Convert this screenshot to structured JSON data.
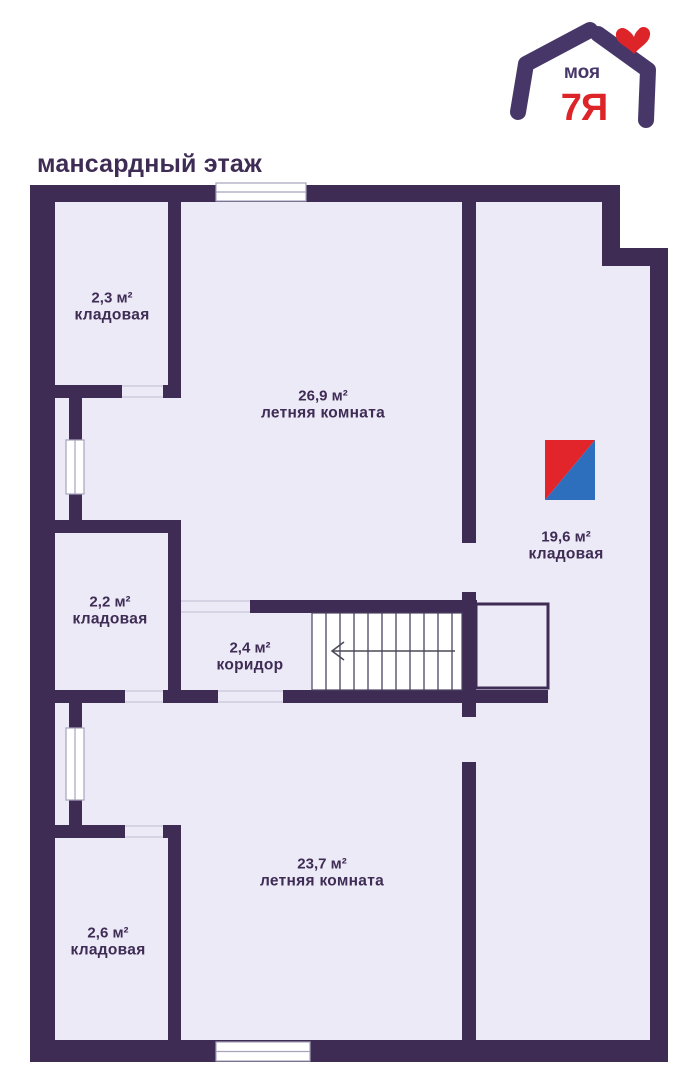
{
  "title": "мансардный этаж",
  "logo": {
    "brand_top": "моя",
    "brand_main": "7Я",
    "purple": "#473768",
    "red": "#dd2429"
  },
  "colors": {
    "wall": "#3e2c55",
    "floor": "#eceaf6",
    "stair_white": "#ffffff",
    "icon_red": "#e2242b",
    "icon_blue": "#2e6fbd",
    "text": "#3e2c55"
  },
  "rooms": [
    {
      "area": "2,3 м²",
      "name": "кладовая"
    },
    {
      "area": "26,9 м²",
      "name": "летняя комната"
    },
    {
      "area": "19,6 м²",
      "name": "кладовая"
    },
    {
      "area": "2,2 м²",
      "name": "кладовая"
    },
    {
      "area": "2,4 м²",
      "name": "коридор"
    },
    {
      "area": "23,7 м²",
      "name": "летняя комната"
    },
    {
      "area": "2,6 м²",
      "name": "кладовая"
    }
  ]
}
